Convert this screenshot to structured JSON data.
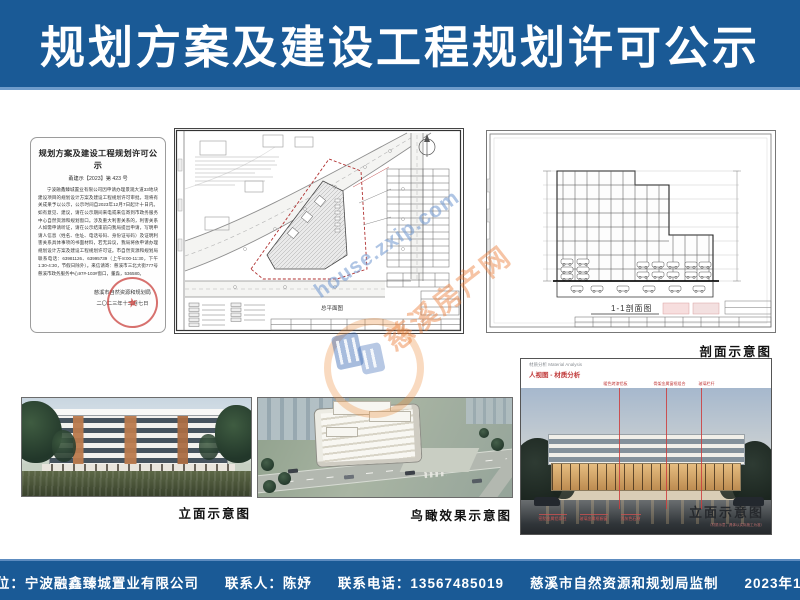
{
  "header": {
    "title": "规划方案及建设工程规划许可公示"
  },
  "colors": {
    "banner_blue": "#1a5a96",
    "banner_edge_light": "#6f9ccb",
    "stamp_red": "#c63430",
    "callout_red": "#c03a3a",
    "watermark_blue": "#6e96cd",
    "watermark_orange": "#eb7d37"
  },
  "doc": {
    "title": "规划方案及建设工程规划许可公示",
    "doc_no": "甬建示【2023】第 423 号",
    "body": "宁波融鑫臻城置业有限公司因申请办理景观大道33地块建设项目的规划设计方案及建设工程规划许可审批，现将有关成果予以公示，公示时间自2023年12月7日起计十日内。如有意见、建议，请在公示期间来电或来信寄到市政务服务中心自然资源和规划窗口。涉及重大利害关系的，利害关系人如需申请听证，请在公示结束前向我局提出申请，写明申请人信息（姓名、住址、电话号码、身份证号码）及证明利害关系具体事项的书面材料，若无异议，我局将依申请办理规划设计方案及建设工程规划许可证。市自然资源和规划局联系电话：63981126、63995739（上午8:00-11:30，下午1:30-4:30，节假日除外）。来信请寄：慈溪市三北大街777号慈溪市政务服务中心97#-103#窗口，董淼，536580。",
    "signature": "慈溪市自然资源和规划局",
    "date": "二〇二三年十二月七日"
  },
  "drawings": {
    "site_plan_label": "总平面图",
    "section_label": "1-1剖面图",
    "section_caption": "剖面示意图"
  },
  "photos": {
    "elevation_caption": "立面示意图",
    "aerial_caption": "鸟瞰效果示意图"
  },
  "material": {
    "header_small": "材质分析 Material Analysis",
    "header_red": "人视图 - 材质分析",
    "top_labels": [
      "暖色烤漆铝板",
      "骨架金属窗框组合",
      "玻璃栏杆"
    ],
    "bottom_labels": [
      "密肋金属铝条柱",
      "玻璃金属框橱窗",
      "浅灰色石材"
    ],
    "caption": "立面示意图",
    "caption_sub": "（材质示意，具体以实际施工为准）"
  },
  "watermark": {
    "site": "house.zxip.com",
    "name": "慈溪房产网"
  },
  "footer": {
    "items": [
      "建设单位：宁波融鑫臻城置业有限公司",
      "联系人：陈妤",
      "联系电话：13567485019",
      "慈溪市自然资源和规划局监制",
      "2023年12月7日"
    ]
  }
}
